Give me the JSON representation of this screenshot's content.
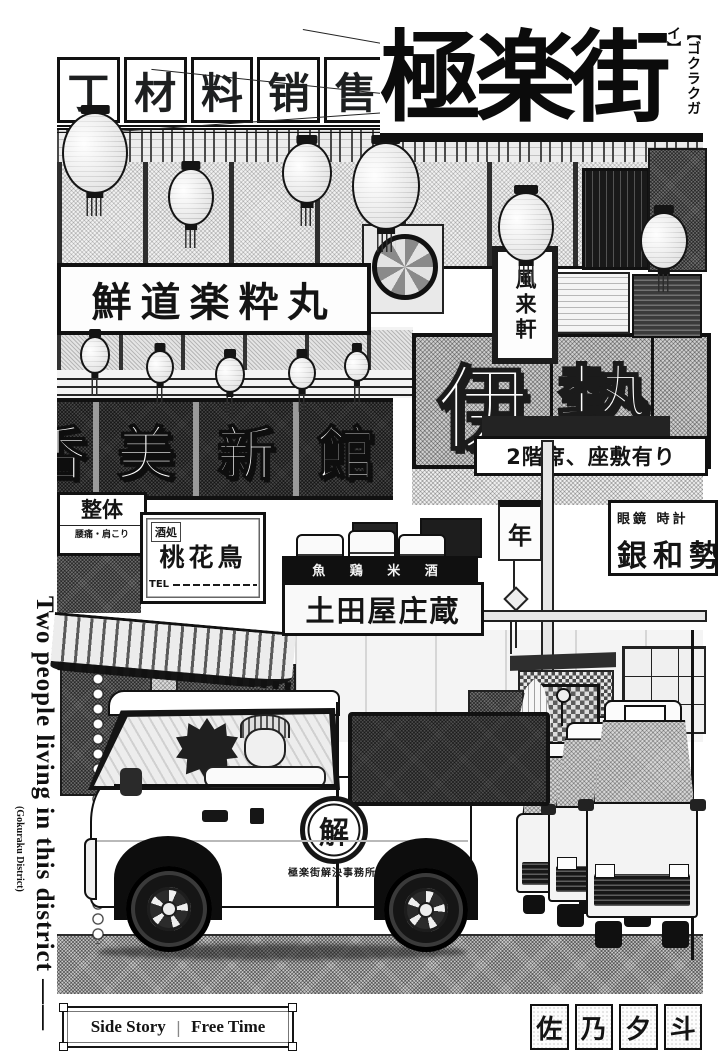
{
  "header": {
    "title": "極楽街",
    "furigana": "【ゴクラクガイ】"
  },
  "margin_note": {
    "main": "Two people living in this district ——",
    "sub": "(Gokuraku District)"
  },
  "signs": {
    "materials_chars": [
      "丁",
      "材",
      "料",
      "销",
      "售"
    ],
    "calligraphy": "鮮道楽粋丸",
    "fuuraiken": "風来軒",
    "ise_chars": [
      "伊",
      "勢"
    ],
    "seat_notice": "2階席、座敷有り",
    "hotel_chars": [
      "香",
      "美",
      "新",
      "館"
    ],
    "seitai_main": "整体",
    "seitai_sub": "腰痛・肩こり",
    "izakaya_type": "酒処",
    "izakaya_name": "桃花鳥",
    "izakaya_tel": "TEL",
    "tavern_items": "魚 鶏 米 酒",
    "tavern_name": "土田屋庄蔵",
    "optician_items": "眼鏡 時計",
    "optician_name": "銀和勢",
    "banner_char": "年"
  },
  "van": {
    "logo_char": "解",
    "company_name": "極楽街解決事務所"
  },
  "footer": {
    "story_label": "Side Story",
    "separator": "|",
    "story_title": "Free Time",
    "author_chars": [
      "佐",
      "乃",
      "夕",
      "斗"
    ]
  },
  "colors": {
    "ink": "#141414",
    "paper": "#ffffff"
  }
}
